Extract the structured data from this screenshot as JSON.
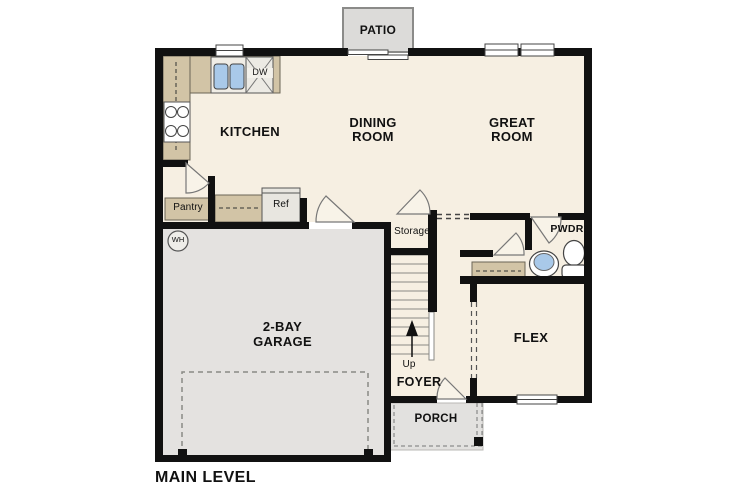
{
  "plan": {
    "title": "MAIN LEVEL",
    "rooms": {
      "patio": "PATIO",
      "kitchen": "KITCHEN",
      "dining": "DINING ROOM",
      "great": "GREAT ROOM",
      "garage": "2-BAY GARAGE",
      "flex": "FLEX",
      "pwdr": "PWDR",
      "foyer": "FOYER",
      "porch": "PORCH",
      "storage": "Storage",
      "pantry": "Pantry"
    },
    "fixtures": {
      "ref": "Ref",
      "dw": "DW",
      "wh": "WH",
      "up": "Up"
    },
    "colors": {
      "wall": "#111111",
      "floor": "#f6efe2",
      "garage_floor": "#e4e2e0",
      "patio_slab": "#dcdbd9",
      "porch_slab": "#e2e1df",
      "counter": "#d2c4a6",
      "fixture_blue": "#a9c9e9",
      "text": "#111111"
    }
  }
}
